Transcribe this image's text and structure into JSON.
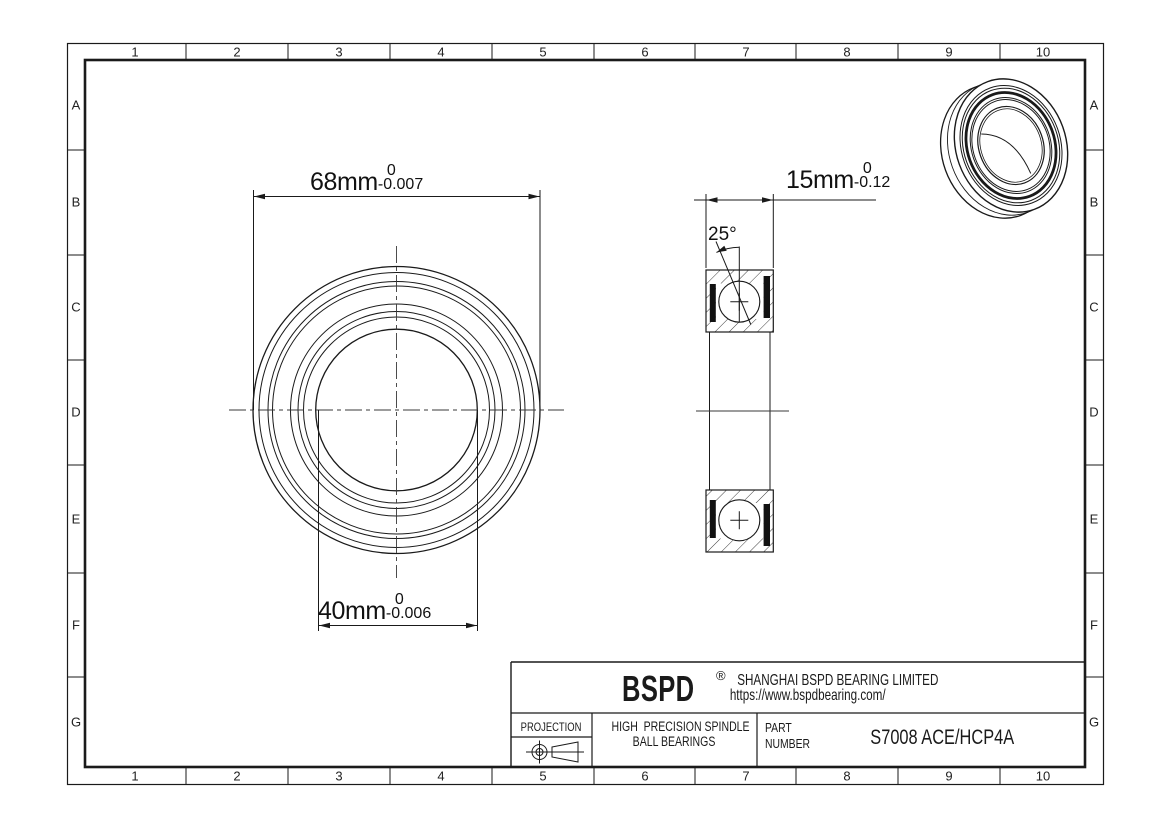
{
  "sheet": {
    "background": "#ffffff",
    "line_color": "#1a1a1a"
  },
  "frame": {
    "columns": [
      "1",
      "2",
      "3",
      "4",
      "5",
      "6",
      "7",
      "8",
      "9",
      "10"
    ],
    "rows": [
      "A",
      "B",
      "C",
      "D",
      "E",
      "F",
      "G"
    ]
  },
  "dimensions": {
    "outer_diameter": {
      "value": "68mm",
      "tol_upper": "0",
      "tol_lower": "-0.007"
    },
    "bore_diameter": {
      "value": "40mm",
      "tol_upper": "0",
      "tol_lower": "-0.006"
    },
    "width": {
      "value": "15mm",
      "tol_upper": "0",
      "tol_lower": "-0.12"
    },
    "contact_angle": "25°"
  },
  "title_block": {
    "logo": "BSPD",
    "registered_mark": "®",
    "company": "SHANGHAI BSPD BEARING LIMITED",
    "website": "https://www.bspdbearing.com/",
    "projection_label": "PROJECTION",
    "product_line1": "HIGH  PRECISION SPINDLE",
    "product_line2": "BALL BEARINGS",
    "part_label_line1": "PART",
    "part_label_line2": "NUMBER",
    "part_number": "S7008 ACE/HCP4A"
  }
}
